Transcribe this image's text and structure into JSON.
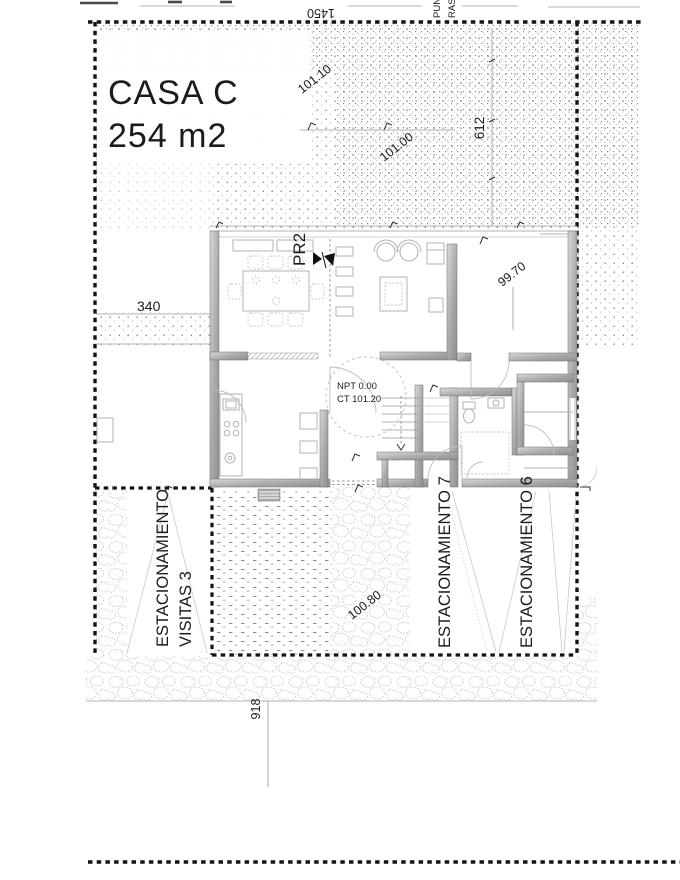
{
  "plan": {
    "title": "CASA C",
    "area": "254 m2",
    "point_ref": "PR2",
    "level_note": {
      "line1": "NPT 0.00",
      "line2": "CT 101.20"
    },
    "boundary_labels": {
      "top_partial_1": "PUN",
      "top_partial_2": "RASA"
    }
  },
  "levels": {
    "garden_upper": "101.10",
    "garden_lower": "101.00",
    "terrace_right": "99.70",
    "driveway": "100.80"
  },
  "dimensions": {
    "top_width": "1450",
    "right_depth": "612",
    "left_offset": "340",
    "bottom_width": "918"
  },
  "parking": {
    "visitas_line1": "ESTACIONAMIENTO",
    "visitas_line2": "VISITAS 3",
    "space7": "ESTACIONAMIENTO 7",
    "space6": "ESTACIONAMIENTO 6"
  },
  "colors": {
    "ink": "#1b1b1b",
    "boundary": "#141414",
    "wall_dark": "#8f8f8f",
    "wall_light": "#dcdcdc",
    "thin_line": "#9a9a9a",
    "stipple_dot": "#8c8c8c",
    "pebble": "#c6c6c6"
  }
}
